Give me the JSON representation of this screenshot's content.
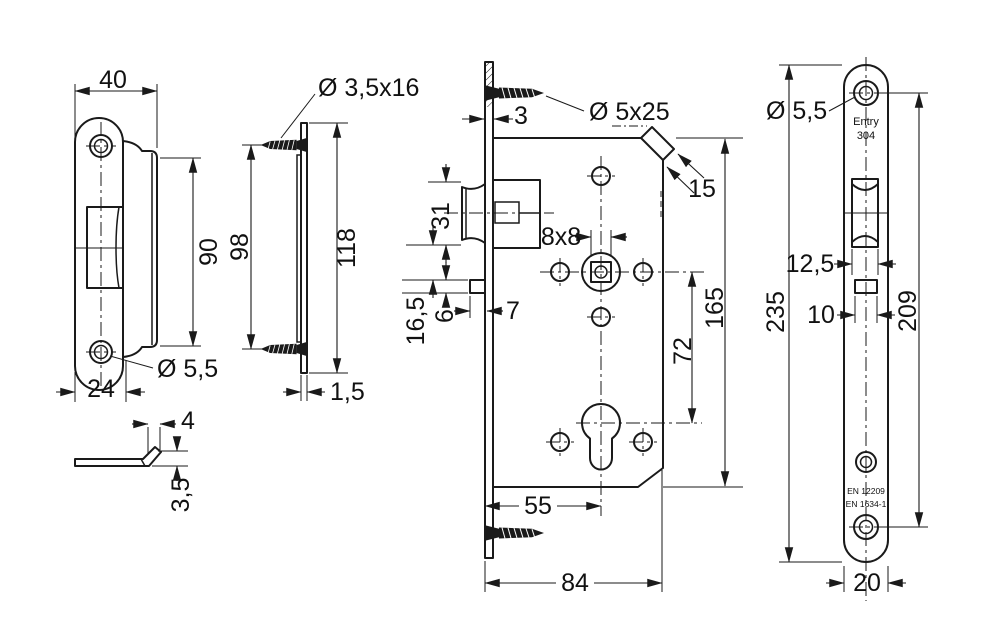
{
  "title": "Mortise lock technical drawing",
  "colors": {
    "line": "#1a1a1a",
    "background": "#ffffff"
  },
  "views": {
    "strike_plate_front": {
      "dim_width": "40",
      "dim_flange_height": "90",
      "dim_bottom_width": "24",
      "label_hole_dia": "Ø 5,5"
    },
    "strike_plate_side": {
      "label_screw": "Ø 3,5x16",
      "dim_screw_spacing": "98",
      "dim_length": "118",
      "dim_thickness": "1,5"
    },
    "lip_detail": {
      "dim_width": "4",
      "dim_height": "3,5"
    },
    "lock_body": {
      "dim_faceplate_thickness": "3",
      "label_screw": "Ø 5x25",
      "dim_chamfer": "15",
      "dim_latch_height": "31",
      "dim_spindle": "8x8",
      "dim_gap": "16,5",
      "dim_aux_height": "6",
      "dim_aux_protrusion": "7",
      "dim_hub_to_cylinder": "72",
      "dim_case_height": "165",
      "dim_backset": "55",
      "dim_case_depth": "84"
    },
    "faceplate_front": {
      "label_hole_dia": "Ø 5,5",
      "brand_line1": "Entry",
      "brand_line2": "304",
      "dim_latch_width": "12,5",
      "dim_aux_width": "10",
      "dim_length": "235",
      "dim_hole_spacing": "209",
      "dim_width": "20",
      "cert_line1": "EN 12209",
      "cert_line2": "EN 1634-1"
    }
  }
}
